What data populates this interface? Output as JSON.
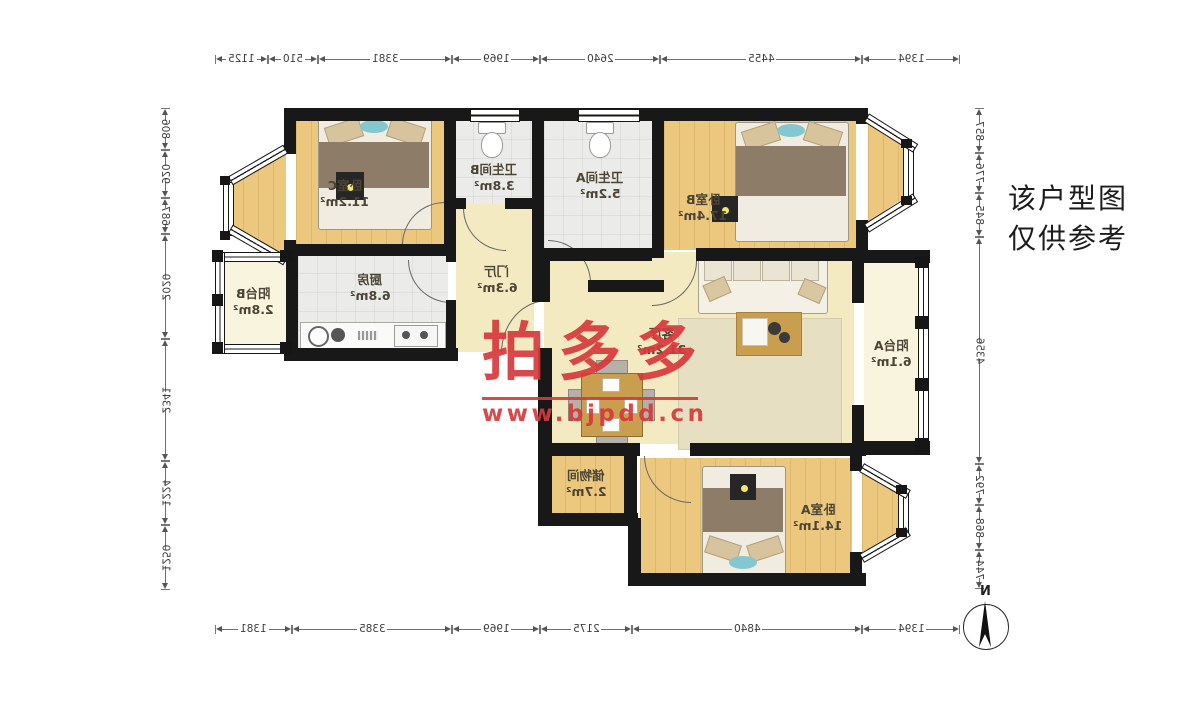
{
  "plan": {
    "rooms": [
      {
        "name": "卧室C",
        "area": "11.2m²"
      },
      {
        "name": "卫生间B",
        "area": "3.8m²"
      },
      {
        "name": "卫生间A",
        "area": "5.2m²"
      },
      {
        "name": "卧室B",
        "area": "17.4m²"
      },
      {
        "name": "阳台B",
        "area": "2.8m²"
      },
      {
        "name": "厨房",
        "area": "6.8m²"
      },
      {
        "name": "门厅",
        "area": "6.3m²"
      },
      {
        "name": "客厅",
        "area": "31.2m²"
      },
      {
        "name": "阳台A",
        "area": "6.1m²"
      },
      {
        "name": "储物间",
        "area": "2.7m²"
      },
      {
        "name": "卧室A",
        "area": "14.1m²"
      }
    ],
    "dims": {
      "top": [
        "1125",
        "510",
        "3381",
        "1969",
        "2640",
        "4455",
        "1394"
      ],
      "bottom": [
        "1381",
        "3385",
        "1969",
        "2175",
        "4840",
        "1394"
      ],
      "left": [
        "806",
        "920",
        "687",
        "2020",
        "2341",
        "1224",
        "1250"
      ],
      "right": [
        "857",
        "776",
        "845",
        "4356",
        "792",
        "868",
        "744"
      ]
    }
  },
  "watermark": {
    "brand": "拍多多",
    "url": "www.bjpdd.cn",
    "color": "#d6393b"
  },
  "note": {
    "line1": "该户型图",
    "line2": "仅供参考"
  },
  "compass": {
    "north_label": "N"
  }
}
